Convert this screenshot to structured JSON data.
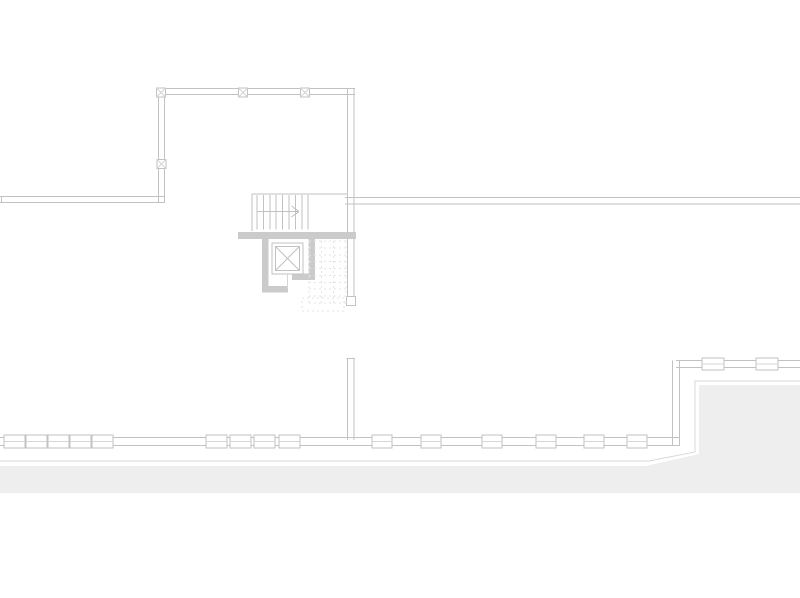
{
  "meta": {
    "canvas": {
      "width": 800,
      "height": 598
    },
    "drawing_type": "architectural-floor-plan"
  },
  "colors": {
    "bg": "#ffffff",
    "wall_line": "#c2c2c2",
    "light_line": "#d6d6d6",
    "faint_line": "#e4e4e4",
    "wall_fill": "#cbcbcb",
    "ground_fill": "#eeeeee",
    "outline": "#d9d9d9"
  },
  "plan": {
    "items": [
      {
        "t": "pg",
        "nm": "ground-mass-fill",
        "f": "ground_fill",
        "pts": [
          [
            0,
            466
          ],
          [
            646,
            466
          ],
          [
            699,
            454
          ],
          [
            699,
            385
          ],
          [
            800,
            385
          ],
          [
            800,
            493
          ],
          [
            0,
            493
          ]
        ]
      },
      {
        "t": "pl",
        "nm": "ground-edge-outline",
        "c": "outline",
        "pts": [
          [
            0,
            461
          ],
          [
            649,
            461
          ],
          [
            695,
            452
          ],
          [
            695,
            381
          ],
          [
            800,
            381
          ]
        ]
      },
      {
        "t": "dlh",
        "nm": "wall-top",
        "x1": 158,
        "x2": 355,
        "y": 88.5,
        "g": 6,
        "c": "wall_line"
      },
      {
        "t": "dlv",
        "nm": "wall-left-vertical",
        "x": 158.5,
        "y1": 88.5,
        "y2": 203,
        "g": 6,
        "c": "wall_line"
      },
      {
        "t": "dlh",
        "nm": "wall-left-horizontal",
        "x1": 0,
        "x2": 164.5,
        "y": 196.5,
        "g": 6,
        "c": "wall_line"
      },
      {
        "t": "ln",
        "nm": "wall-left-horizontal-cap",
        "x1": 1.5,
        "y1": 196.5,
        "x2": 1.5,
        "y2": 202.5,
        "c": "wall_line"
      },
      {
        "t": "dlv",
        "nm": "wall-shaft-right-vertical",
        "x": 347.5,
        "y1": 88,
        "y2": 297,
        "g": 6.5,
        "c": "wall_line"
      },
      {
        "t": "rc",
        "nm": "wall-shaft-end-cap",
        "x": 346.5,
        "y": 296.5,
        "w": 9,
        "h": 9,
        "f": "bg",
        "s": "wall_line"
      },
      {
        "t": "dlh",
        "nm": "wall-right-wing",
        "x1": 345,
        "x2": 800,
        "y": 197.5,
        "g": 6.5,
        "c": "wall_line"
      },
      {
        "t": "mk",
        "nm": "column-marker",
        "x": 161,
        "y": 92.5,
        "s": 9
      },
      {
        "t": "mk",
        "nm": "column-marker",
        "x": 243,
        "y": 92.5,
        "s": 9
      },
      {
        "t": "mk",
        "nm": "column-marker",
        "x": 305,
        "y": 92.5,
        "s": 9
      },
      {
        "t": "mk",
        "nm": "column-marker",
        "x": 161.5,
        "y": 164,
        "s": 9
      },
      {
        "t": "ln",
        "nm": "stair-top-edge",
        "x1": 252,
        "y1": 194,
        "x2": 348,
        "y2": 194,
        "c": "wall_line"
      },
      {
        "t": "ln",
        "nm": "stair-left-edge",
        "x1": 252,
        "y1": 194,
        "x2": 252,
        "y2": 231,
        "c": "wall_line"
      },
      {
        "t": "tr",
        "nm": "stair-treads",
        "x0": 257,
        "dx": 6.4,
        "cnt": 9,
        "y1": 195,
        "y2": 229.5,
        "c": "wall_line"
      },
      {
        "t": "ln",
        "nm": "stair-walk-line",
        "x1": 257,
        "y1": 211.5,
        "x2": 299,
        "y2": 211.5,
        "c": "wall_line"
      },
      {
        "t": "ln",
        "nm": "stair-arrow-head",
        "x1": 299,
        "y1": 211.5,
        "x2": 291.5,
        "y2": 206,
        "c": "wall_line"
      },
      {
        "t": "ln",
        "nm": "stair-arrow-head",
        "x1": 299,
        "y1": 211.5,
        "x2": 291.5,
        "y2": 217,
        "c": "wall_line"
      },
      {
        "t": "rc",
        "nm": "elevator-wall-top",
        "x": 238,
        "y": 232,
        "w": 118,
        "h": 7,
        "f": "wall_fill"
      },
      {
        "t": "rc",
        "nm": "elevator-wall-left",
        "x": 262,
        "y": 239,
        "w": 6.5,
        "h": 53,
        "f": "wall_fill"
      },
      {
        "t": "rc",
        "nm": "elevator-wall-bottom-left",
        "x": 262,
        "y": 286,
        "w": 26,
        "h": 6.5,
        "f": "wall_fill"
      },
      {
        "t": "rc",
        "nm": "elevator-wall-right",
        "x": 308.5,
        "y": 239,
        "w": 6.5,
        "h": 37,
        "f": "wall_fill"
      },
      {
        "t": "rc",
        "nm": "elevator-wall-bottom-right",
        "x": 292,
        "y": 273.5,
        "w": 23,
        "h": 6.5,
        "f": "wall_fill"
      },
      {
        "t": "rc",
        "nm": "elevator-car-outer",
        "x": 272,
        "y": 243,
        "w": 31,
        "h": 31,
        "f": "bg",
        "s": "wall_line"
      },
      {
        "t": "rc",
        "nm": "elevator-car-inner",
        "x": 275.5,
        "y": 246.5,
        "w": 24,
        "h": 24,
        "s": "wall_line"
      },
      {
        "t": "ln",
        "nm": "elevator-car-diagonal",
        "x1": 275.5,
        "y1": 246.5,
        "x2": 299.5,
        "y2": 270.5,
        "c": "wall_line"
      },
      {
        "t": "ln",
        "nm": "elevator-car-diagonal",
        "x1": 299.5,
        "y1": 246.5,
        "x2": 275.5,
        "y2": 270.5,
        "c": "wall_line"
      },
      {
        "t": "ln",
        "nm": "elevator-door-centerline",
        "x1": 287.5,
        "y1": 274,
        "x2": 287.5,
        "y2": 289,
        "c": "light_line"
      },
      {
        "t": "dg",
        "nm": "hidden-stair-dashed",
        "x1": 309,
        "x2": 346,
        "y1": 241,
        "y2": 303,
        "rows": 9,
        "cols": 2,
        "dash": "2,3",
        "c": "faint_line"
      },
      {
        "t": "rc",
        "nm": "hidden-stair-landing",
        "x": 302,
        "y": 298,
        "w": 42,
        "h": 13,
        "s": "faint_line",
        "dash": "2,3"
      },
      {
        "t": "dlv",
        "nm": "wall-lower-middle",
        "x": 347.5,
        "y1": 359,
        "y2": 440,
        "g": 6.5,
        "c": "wall_line"
      },
      {
        "t": "ln",
        "nm": "wall-lower-middle-cap",
        "x1": 346.5,
        "y1": 358.5,
        "x2": 355,
        "y2": 358.5,
        "c": "wall_line"
      },
      {
        "t": "dlh",
        "nm": "window-band-main",
        "x1": 0,
        "x2": 680,
        "y": 437.5,
        "g": 8,
        "c": "wall_line"
      },
      {
        "t": "fr",
        "nm": "window-frame",
        "y": 435,
        "h": 13,
        "bw": 21,
        "xs": [
          4,
          26,
          48,
          70,
          92
        ]
      },
      {
        "t": "fr",
        "nm": "window-frame",
        "y": 435,
        "h": 13,
        "bw": 21,
        "xs": [
          206,
          230,
          254,
          279
        ]
      },
      {
        "t": "fr",
        "nm": "window-frame",
        "y": 435,
        "h": 13,
        "bw": 20,
        "xs": [
          372,
          421,
          482,
          536,
          584,
          627
        ]
      },
      {
        "t": "dlh",
        "nm": "window-band-upper-right",
        "x1": 676,
        "x2": 800,
        "y": 360.5,
        "g": 7,
        "c": "wall_line"
      },
      {
        "t": "fr",
        "nm": "window-frame",
        "y": 358,
        "h": 12,
        "bw": 22,
        "xs": [
          702,
          756
        ]
      },
      {
        "t": "dlv",
        "nm": "wall-step-vertical",
        "x": 672.5,
        "y1": 360.5,
        "y2": 446,
        "g": 7,
        "c": "wall_line"
      }
    ]
  }
}
